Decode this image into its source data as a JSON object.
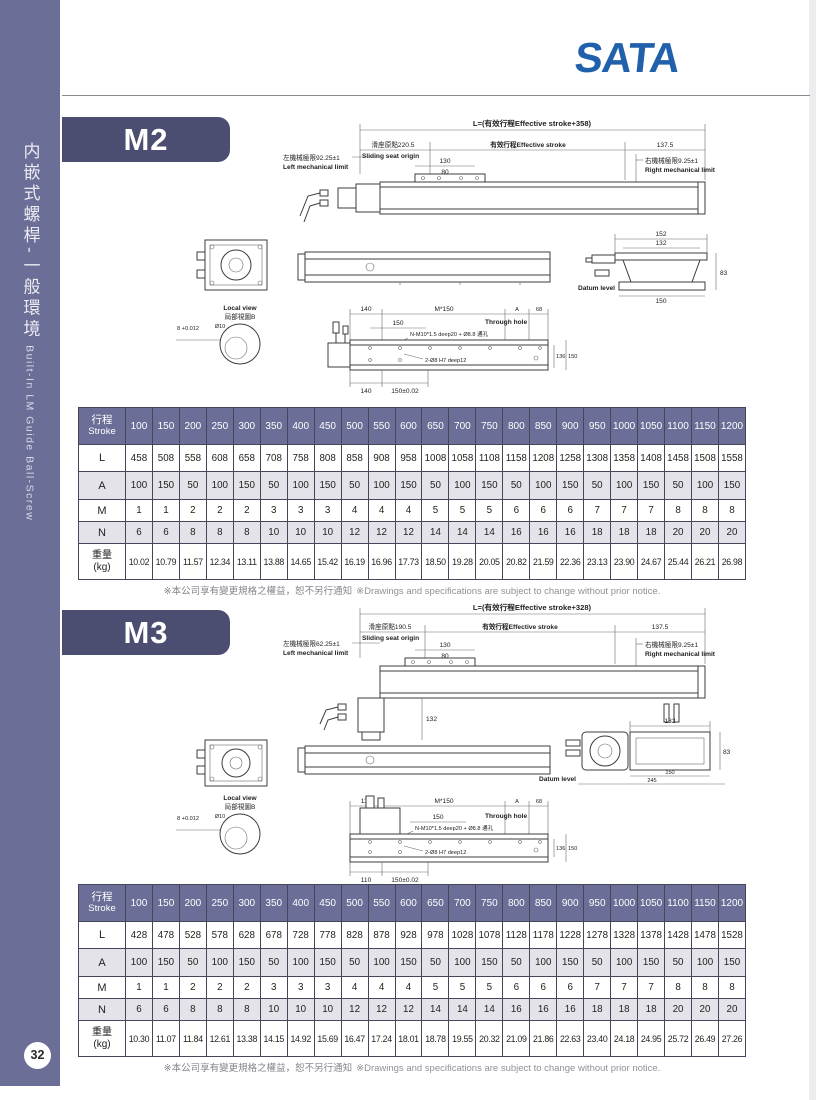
{
  "brand": {
    "name": "SATA",
    "color": "#2161ac"
  },
  "sidebar": {
    "title_zh": "内嵌式螺桿-一般環境",
    "title_en": "Built-In LM Guide  Ball-Screw",
    "page_number": "32"
  },
  "note": {
    "zh": "※本公司享有變更規格之權益，恕不另行通知",
    "en": "※Drawings and specifications are subject to change without prior notice."
  },
  "sections": [
    {
      "model": "M2",
      "drawing": {
        "total": "L=(有效行程Effective stroke+358)",
        "origin_zh": "滑座原點220.5",
        "origin_en": "Sliding seat origin",
        "effective": "有效行程Effective stroke",
        "end_offset": "137.5",
        "left_limit_zh": "左機械極限92.25±1",
        "left_limit_en": "Left mechanical limit",
        "right_limit_zh": "右機械極限9.25±1",
        "right_limit_en": "Right mechanical limit",
        "dim_a": "130",
        "dim_b": "80",
        "cs_top": "152",
        "cs_mid": "132",
        "cs_h": "83",
        "cs_w": "150",
        "datum": "Datum level",
        "local_en": "Local view",
        "local_zh": "局部視圖B",
        "bore": "8 +0.012",
        "cbore": "Ø10",
        "p1": "140",
        "p2": "150",
        "pitch": "M*150",
        "pa": "A",
        "pe": "68",
        "through": "Through hole",
        "screw": "N-M10*1.5 deep20 + Ø8.8 通孔",
        "pin": "2-Ø8 H7 deep12",
        "h1": "136",
        "h2": "150",
        "b1": "140",
        "b2": "150±0.02"
      },
      "table": {
        "header_zh": "行程",
        "header_en": "Stroke",
        "strokes": [
          "100",
          "150",
          "200",
          "250",
          "300",
          "350",
          "400",
          "450",
          "500",
          "550",
          "600",
          "650",
          "700",
          "750",
          "800",
          "850",
          "900",
          "950",
          "1000",
          "1050",
          "1100",
          "1150",
          "1200"
        ],
        "rows": [
          {
            "label": "L",
            "shaded": false,
            "values": [
              "458",
              "508",
              "558",
              "608",
              "658",
              "708",
              "758",
              "808",
              "858",
              "908",
              "958",
              "1008",
              "1058",
              "1108",
              "1158",
              "1208",
              "1258",
              "1308",
              "1358",
              "1408",
              "1458",
              "1508",
              "1558"
            ]
          },
          {
            "label": "A",
            "shaded": true,
            "values": [
              "100",
              "150",
              "50",
              "100",
              "150",
              "50",
              "100",
              "150",
              "50",
              "100",
              "150",
              "50",
              "100",
              "150",
              "50",
              "100",
              "150",
              "50",
              "100",
              "150",
              "50",
              "100",
              "150"
            ]
          },
          {
            "label": "M",
            "shaded": false,
            "values": [
              "1",
              "1",
              "2",
              "2",
              "2",
              "3",
              "3",
              "3",
              "4",
              "4",
              "4",
              "5",
              "5",
              "5",
              "6",
              "6",
              "6",
              "7",
              "7",
              "7",
              "8",
              "8",
              "8"
            ]
          },
          {
            "label": "N",
            "shaded": true,
            "values": [
              "6",
              "6",
              "8",
              "8",
              "8",
              "10",
              "10",
              "10",
              "12",
              "12",
              "12",
              "14",
              "14",
              "14",
              "16",
              "16",
              "16",
              "18",
              "18",
              "18",
              "20",
              "20",
              "20"
            ]
          },
          {
            "label": "重量",
            "label2": "(kg)",
            "weight": true,
            "shaded": false,
            "values": [
              "10.02",
              "10.79",
              "11.57",
              "12.34",
              "13.11",
              "13.88",
              "14.65",
              "15.42",
              "16.19",
              "16.96",
              "17.73",
              "18.50",
              "19.28",
              "20.05",
              "20.82",
              "21.59",
              "22.36",
              "23.13",
              "23.90",
              "24.67",
              "25.44",
              "26.21",
              "26.98"
            ]
          }
        ]
      }
    },
    {
      "model": "M3",
      "drawing": {
        "total": "L=(有效行程Effective stroke+328)",
        "origin_zh": "滑座原點190.5",
        "origin_en": "Sliding seat origin",
        "effective": "有效行程Effective stroke",
        "end_offset": "137.5",
        "left_limit_zh": "左機械極限62.25±1",
        "left_limit_en": "Left mechanical limit",
        "right_limit_zh": "右機械極限9.25±1",
        "right_limit_en": "Right mechanical limit",
        "dim_a": "130",
        "dim_b": "80",
        "dim_v": "132",
        "cs_top": "132",
        "cs_h": "83",
        "cs_w": "150",
        "cs_w2": "245",
        "datum": "Datum level",
        "local_en": "Local view",
        "local_zh": "局部視圖B",
        "bore": "8 +0.012",
        "cbore": "Ø10",
        "p1": "110",
        "p2": "150",
        "pitch": "M*150",
        "pa": "A",
        "pe": "68",
        "through": "Through hole",
        "screw": "N-M10*1.5 deep20 + Ø8.8 通孔",
        "pin": "2-Ø8 H7 deep12",
        "h1": "136",
        "h2": "150",
        "b1": "110",
        "b2": "150±0.02"
      },
      "table": {
        "header_zh": "行程",
        "header_en": "Stroke",
        "strokes": [
          "100",
          "150",
          "200",
          "250",
          "300",
          "350",
          "400",
          "450",
          "500",
          "550",
          "600",
          "650",
          "700",
          "750",
          "800",
          "850",
          "900",
          "950",
          "1000",
          "1050",
          "1100",
          "1150",
          "1200"
        ],
        "rows": [
          {
            "label": "L",
            "shaded": false,
            "values": [
              "428",
              "478",
              "528",
              "578",
              "628",
              "678",
              "728",
              "778",
              "828",
              "878",
              "928",
              "978",
              "1028",
              "1078",
              "1128",
              "1178",
              "1228",
              "1278",
              "1328",
              "1378",
              "1428",
              "1478",
              "1528"
            ]
          },
          {
            "label": "A",
            "shaded": true,
            "values": [
              "100",
              "150",
              "50",
              "100",
              "150",
              "50",
              "100",
              "150",
              "50",
              "100",
              "150",
              "50",
              "100",
              "150",
              "50",
              "100",
              "150",
              "50",
              "100",
              "150",
              "50",
              "100",
              "150"
            ]
          },
          {
            "label": "M",
            "shaded": false,
            "values": [
              "1",
              "1",
              "2",
              "2",
              "2",
              "3",
              "3",
              "3",
              "4",
              "4",
              "4",
              "5",
              "5",
              "5",
              "6",
              "6",
              "6",
              "7",
              "7",
              "7",
              "8",
              "8",
              "8"
            ]
          },
          {
            "label": "N",
            "shaded": true,
            "values": [
              "6",
              "6",
              "8",
              "8",
              "8",
              "10",
              "10",
              "10",
              "12",
              "12",
              "12",
              "14",
              "14",
              "14",
              "16",
              "16",
              "16",
              "18",
              "18",
              "18",
              "20",
              "20",
              "20"
            ]
          },
          {
            "label": "重量",
            "label2": "(kg)",
            "weight": true,
            "shaded": false,
            "values": [
              "10.30",
              "11.07",
              "11.84",
              "12.61",
              "13.38",
              "14.15",
              "14.92",
              "15.69",
              "16.47",
              "17.24",
              "18.01",
              "18.78",
              "19.55",
              "20.32",
              "21.09",
              "21.86",
              "22.63",
              "23.40",
              "24.18",
              "24.95",
              "25.72",
              "26.49",
              "27.26"
            ]
          }
        ]
      }
    }
  ]
}
